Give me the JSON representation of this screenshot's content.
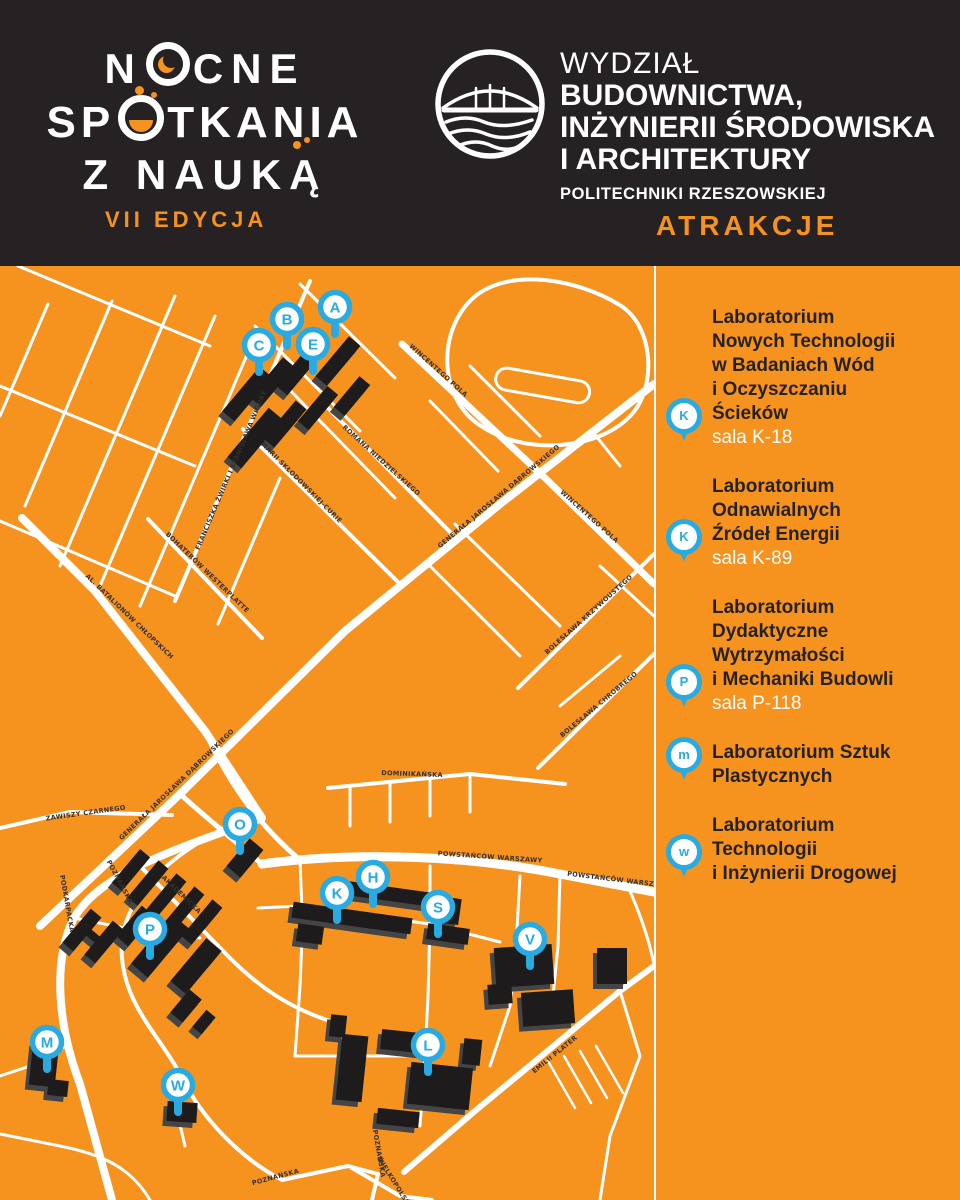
{
  "colors": {
    "orange": "#F6921E",
    "dark": "#262223",
    "pin_blue": "#29ABE2",
    "street_white": "#FFFFFF",
    "building_black": "#1D1B1B",
    "building_side": "#454545"
  },
  "header": {
    "event_logo": {
      "line1_pre": "N",
      "line1_post": "CNE",
      "line2_pre": "SP",
      "line2_post": "TKANIA",
      "line3": "Z NAUKĄ",
      "edition": "VII EDYCJA"
    },
    "faculty": {
      "line1": "WYDZIAŁ",
      "line2": "BUDOWNICTWA,",
      "line3": "INŻYNIERII ŚRODOWISKA",
      "line4": "I ARCHITEKTURY",
      "line5": "POLITECHNIKI RZESZOWSKIEJ"
    },
    "attractions_label": "ATRAKCJE"
  },
  "sidebar": {
    "items": [
      {
        "pin": "K",
        "pin_row": 5,
        "name": "Laboratorium\nNowych Technologii\nw Badaniach Wód\ni Oczyszczaniu\nŚcieków",
        "room": "sala K-18"
      },
      {
        "pin": "K",
        "pin_row": 3,
        "name": "Laboratorium\nOdnawialnych\nŹródeł Energii",
        "room": "sala K-89"
      },
      {
        "pin": "P",
        "pin_row": 4,
        "name": "Laboratorium\nDydaktyczne\nWytrzymałości\ni Mechaniki Budowli",
        "room": "sala P-118"
      },
      {
        "pin": "m",
        "pin_row": 1,
        "name": "Laboratorium Sztuk\nPlastycznych",
        "room": ""
      },
      {
        "pin": "w",
        "pin_row": 2,
        "name": "Laboratorium\nTechnologii\ni Inżynierii Drogowej",
        "room": ""
      }
    ]
  },
  "map": {
    "pins": [
      {
        "letter": "A",
        "x": 335,
        "y": 41
      },
      {
        "letter": "B",
        "x": 287,
        "y": 53
      },
      {
        "letter": "C",
        "x": 259,
        "y": 79
      },
      {
        "letter": "E",
        "x": 313,
        "y": 78
      },
      {
        "letter": "O",
        "x": 240,
        "y": 558
      },
      {
        "letter": "P",
        "x": 150,
        "y": 663
      },
      {
        "letter": "K",
        "x": 337,
        "y": 627
      },
      {
        "letter": "H",
        "x": 373,
        "y": 611
      },
      {
        "letter": "S",
        "x": 438,
        "y": 641
      },
      {
        "letter": "V",
        "x": 530,
        "y": 673
      },
      {
        "letter": "M",
        "x": 47,
        "y": 776
      },
      {
        "letter": "W",
        "x": 178,
        "y": 819
      },
      {
        "letter": "L",
        "x": 428,
        "y": 779
      }
    ],
    "street_labels": [
      {
        "text": "WINCENTEGO POLA",
        "x": 437,
        "y": 106,
        "rot": 42
      },
      {
        "text": "WINCENTEGO POLA",
        "x": 588,
        "y": 252,
        "rot": 42
      },
      {
        "text": "ROMANA NIEDZIELSKIEGO",
        "x": 380,
        "y": 196,
        "rot": 42
      },
      {
        "text": "MARII SKŁODOWSKIEJ-CURIE",
        "x": 300,
        "y": 218,
        "rot": 45
      },
      {
        "text": "FRANCISZKA ŻWIRKI I STANISŁAWA WIGURY",
        "x": 233,
        "y": 205,
        "rot": -67
      },
      {
        "text": "GENERAŁA JAROSŁAWA DĄBROWSKIEGO",
        "x": 500,
        "y": 232,
        "rot": -40
      },
      {
        "text": "GENERAŁA JAROSŁAWA DĄBROWSKIEGO",
        "x": 178,
        "y": 520,
        "rot": -44
      },
      {
        "text": "AL. BATALIONÓW CHŁOPSKICH",
        "x": 128,
        "y": 352,
        "rot": 44
      },
      {
        "text": "BOHATERÓW WESTERPLATTE",
        "x": 206,
        "y": 308,
        "rot": 44
      },
      {
        "text": "ZAWISZY CZARNEGO",
        "x": 86,
        "y": 549,
        "rot": -8
      },
      {
        "text": "BOLESŁAWA KRZYWOUSTEGO",
        "x": 590,
        "y": 350,
        "rot": -42
      },
      {
        "text": "BOLESŁAWA CHROBREGO",
        "x": 600,
        "y": 440,
        "rot": -40
      },
      {
        "text": "DOMINIKAŃSKA",
        "x": 412,
        "y": 510,
        "rot": 2
      },
      {
        "text": "PODKARPACKA",
        "x": 65,
        "y": 638,
        "rot": 80
      },
      {
        "text": "POZNAŃSKA",
        "x": 118,
        "y": 617,
        "rot": 62
      },
      {
        "text": "AKADEMICKA",
        "x": 180,
        "y": 630,
        "rot": 44
      },
      {
        "text": "POWSTAŃCÓW WARSZAWY",
        "x": 490,
        "y": 593,
        "rot": 4
      },
      {
        "text": "POWSTAŃCÓW WARSZAWY",
        "x": 619,
        "y": 616,
        "rot": 7
      },
      {
        "text": "EMILII PLATER",
        "x": 556,
        "y": 790,
        "rot": -39
      },
      {
        "text": "POZNAŃSKA",
        "x": 276,
        "y": 913,
        "rot": -15
      },
      {
        "text": "POZNAŃSKA",
        "x": 377,
        "y": 888,
        "rot": 80
      },
      {
        "text": "WIELKOPOLSKA",
        "x": 393,
        "y": 918,
        "rot": 58
      }
    ]
  }
}
